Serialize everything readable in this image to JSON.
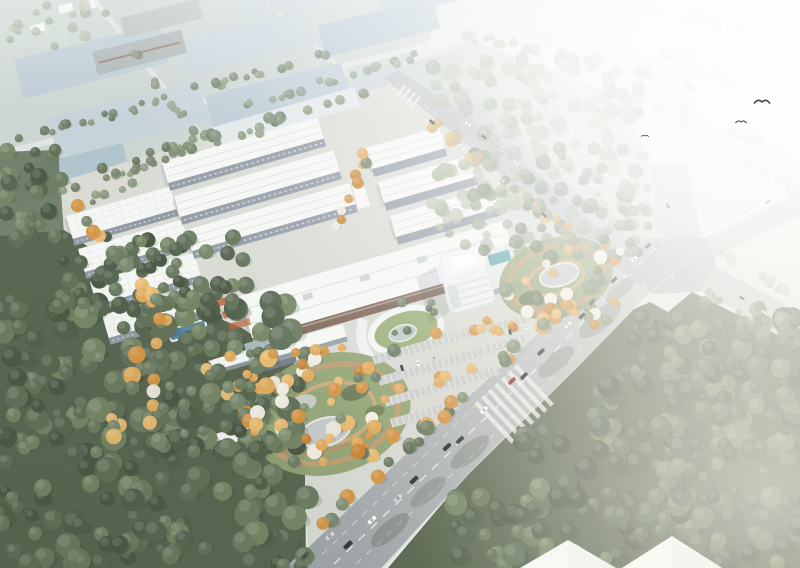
{
  "image": {
    "type": "architectural-aerial-rendering",
    "subject": "Bird's-eye rendering of an industrial park campus: rows of white warehouse buildings, a curved white office tower, landscaped gardens with autumn trees, parking lots, dense green forests and a wide boulevard with traffic crossing a major intersection; distant blue-grey roofed factory district fades into bright haze at the top right.",
    "width": 800,
    "height": 568
  },
  "palette": {
    "bg_a": "#dfe5df",
    "bg_b": "#eceeea",
    "district_ground": "#c9d3d0",
    "district_roof_a": "#b9c9d3",
    "district_roof_b": "#c4d1d8",
    "district_roof_c": "#aec1cc",
    "district_shed": "#a6b1b0",
    "campus_ground": "#d7dad2",
    "roof_white": "#f5f7f4",
    "roof_ridge": "#dde2dd",
    "facade_grey": "#8d96a1",
    "facade_brown": "#7c6252",
    "annex_roof": "#a3b6b8",
    "road_near": "#9da3a6",
    "road_far": "#c7cbca",
    "road_line": "#f4f6f3",
    "apron": "#c3c8c8",
    "forest_dark": "#52604a",
    "forest_right": "#55624b",
    "forest_pale": "#c8d1c4",
    "lawn": "#98ad76",
    "pond": "#c2cacc",
    "pool": "#4f84a6",
    "pool_teal": "#55a1a8",
    "path_tan": "#c29a6f",
    "bed_red": "#b85c35",
    "tower_wall": "#eef1f2",
    "tower_glass": "#b9c4ca",
    "shadow": "#39434b"
  },
  "scene": {
    "car_colors": [
      "#ffffff",
      "#2e3338",
      "#50565c",
      "#8e332c",
      "#d8dadb",
      "#1f2428"
    ],
    "tree_clusters": [
      {
        "name": "forest-topright-fill",
        "shape": "rect",
        "x": 432,
        "y": 58,
        "w": 215,
        "h": 190,
        "n": 150,
        "rmin": 4,
        "rmax": 8,
        "opacity": 0.8,
        "seed": 5,
        "colors": [
          "#99a78d",
          "#a6b297",
          "#b2bba1",
          "#8fa083"
        ]
      },
      {
        "name": "forest-topright-low",
        "shape": "rect",
        "x": 470,
        "y": 148,
        "w": 170,
        "h": 110,
        "n": 60,
        "rmin": 4,
        "rmax": 8,
        "opacity": 0.75,
        "seed": 6,
        "colors": [
          "#68785c",
          "#74866a",
          "#7f9070",
          "#5d6d52"
        ]
      },
      {
        "name": "haze-row-1",
        "shape": "line",
        "x1": 656,
        "y1": 6,
        "x2": 800,
        "y2": 48,
        "jitter": 10,
        "n": 16,
        "rmin": 4,
        "rmax": 6,
        "opacity": 0.6,
        "seed": 7,
        "colors": [
          "#c9bfac",
          "#d6ccba",
          "#beb3a0"
        ]
      },
      {
        "name": "haze-row-2",
        "shape": "line",
        "x1": 640,
        "y1": 50,
        "x2": 800,
        "y2": 100,
        "jitter": 12,
        "n": 18,
        "rmin": 4,
        "rmax": 6,
        "opacity": 0.55,
        "seed": 8,
        "colors": [
          "#c9bfac",
          "#d6ccba",
          "#beb3a0"
        ]
      },
      {
        "name": "haze-row-3",
        "shape": "line",
        "x1": 648,
        "y1": 106,
        "x2": 800,
        "y2": 154,
        "jitter": 12,
        "n": 16,
        "rmin": 4,
        "rmax": 6,
        "opacity": 0.5,
        "seed": 9,
        "colors": [
          "#c9bfac",
          "#d6ccba",
          "#beb3a0"
        ]
      },
      {
        "name": "haze-row-4",
        "shape": "line",
        "x1": 720,
        "y1": 152,
        "x2": 800,
        "y2": 188,
        "jitter": 10,
        "n": 10,
        "rmin": 4,
        "rmax": 6,
        "opacity": 0.45,
        "seed": 10,
        "colors": [
          "#c9bfac",
          "#d6ccba",
          "#beb3a0"
        ]
      },
      {
        "name": "top-road-trees",
        "shape": "line",
        "x1": 460,
        "y1": 34,
        "x2": 700,
        "y2": 86,
        "jitter": 8,
        "n": 20,
        "rmin": 3,
        "rmax": 5,
        "opacity": 0.65,
        "seed": 12,
        "colors": [
          "#99a78d",
          "#a6b297",
          "#b2bba1",
          "#8fa083"
        ]
      },
      {
        "name": "district-row-1",
        "shape": "line",
        "x1": 20,
        "y1": 140,
        "x2": 330,
        "y2": 52,
        "jitter": 8,
        "n": 34,
        "rmin": 3,
        "rmax": 5,
        "opacity": 0.85,
        "seed": 13,
        "colors": [
          "#68785c",
          "#74866a",
          "#7f9070",
          "#5d6d52"
        ]
      },
      {
        "name": "district-row-2",
        "shape": "line",
        "x1": 60,
        "y1": 192,
        "x2": 270,
        "y2": 128,
        "jitter": 8,
        "n": 22,
        "rmin": 3,
        "rmax": 5,
        "opacity": 0.8,
        "seed": 14,
        "colors": [
          "#68785c",
          "#74866a",
          "#7f9070",
          "#5d6d52"
        ]
      },
      {
        "name": "district-row-3",
        "shape": "line",
        "x1": 0,
        "y1": 226,
        "x2": 150,
        "y2": 182,
        "jitter": 8,
        "n": 16,
        "rmin": 3,
        "rmax": 5,
        "opacity": 0.8,
        "seed": 15,
        "colors": [
          "#68785c",
          "#74866a",
          "#7f9070",
          "#5d6d52"
        ]
      },
      {
        "name": "district-row-4",
        "shape": "line",
        "x1": 240,
        "y1": 106,
        "x2": 424,
        "y2": 54,
        "jitter": 8,
        "n": 18,
        "rmin": 3,
        "rmax": 5,
        "opacity": 0.75,
        "seed": 16,
        "colors": [
          "#68785c",
          "#74866a",
          "#7f9070",
          "#5d6d52"
        ]
      },
      {
        "name": "district-row-5",
        "shape": "line",
        "x1": 96,
        "y1": 6,
        "x2": 200,
        "y2": 140,
        "jitter": 8,
        "n": 14,
        "rmin": 3,
        "rmax": 5,
        "opacity": 0.7,
        "seed": 17,
        "colors": [
          "#68785c",
          "#74866a",
          "#7f9070",
          "#5d6d52"
        ]
      },
      {
        "name": "corner-field-trees",
        "shape": "rect",
        "x": 0,
        "y": 0,
        "w": 90,
        "h": 52,
        "n": 14,
        "rmin": 3,
        "rmax": 6,
        "opacity": 0.7,
        "seed": 18,
        "colors": [
          "#99a78d",
          "#a6b297",
          "#b2bba1",
          "#8fa083"
        ]
      },
      {
        "name": "left-strip",
        "shape": "rect",
        "x": 0,
        "y": 150,
        "w": 62,
        "h": 92,
        "n": 26,
        "rmin": 5,
        "rmax": 9,
        "opacity": 0.95,
        "seed": 19,
        "colors": [
          "#44523d",
          "#50604a",
          "#5b6c52",
          "#66775a",
          "#4b5a44",
          "#70815f"
        ]
      },
      {
        "name": "forest-bottomleft",
        "shape": "rect",
        "x": 0,
        "y": 296,
        "w": 308,
        "h": 272,
        "n": 240,
        "rmin": 6,
        "rmax": 13,
        "seed": 20,
        "colors": [
          "#44523d",
          "#50604a",
          "#5b6c52",
          "#66775a",
          "#4b5a44",
          "#70815f"
        ]
      },
      {
        "name": "forest-bottomleft-top",
        "shape": "rect",
        "x": 60,
        "y": 236,
        "w": 190,
        "h": 80,
        "n": 60,
        "rmin": 5,
        "rmax": 9,
        "seed": 21,
        "colors": [
          "#44523d",
          "#50604a",
          "#5b6c52",
          "#66775a",
          "#4b5a44",
          "#70815f"
        ]
      },
      {
        "name": "forest-br-a",
        "shape": "rect",
        "x": 455,
        "y": 495,
        "w": 345,
        "h": 73,
        "n": 85,
        "rmin": 6,
        "rmax": 12,
        "seed": 22,
        "colors": [
          "#44523d",
          "#50604a",
          "#5b6c52",
          "#66775a",
          "#4b5a44",
          "#70815f"
        ]
      },
      {
        "name": "forest-br-b",
        "shape": "rect",
        "x": 520,
        "y": 428,
        "w": 280,
        "h": 72,
        "n": 75,
        "rmin": 6,
        "rmax": 12,
        "seed": 23,
        "colors": [
          "#44523d",
          "#50604a",
          "#5b6c52",
          "#66775a",
          "#4b5a44",
          "#70815f"
        ]
      },
      {
        "name": "forest-br-c",
        "shape": "rect",
        "x": 582,
        "y": 366,
        "w": 218,
        "h": 66,
        "n": 55,
        "rmin": 6,
        "rmax": 12,
        "seed": 24,
        "colors": [
          "#44523d",
          "#50604a",
          "#5b6c52",
          "#66775a",
          "#4b5a44",
          "#70815f"
        ]
      },
      {
        "name": "forest-br-d",
        "shape": "rect",
        "x": 632,
        "y": 316,
        "w": 168,
        "h": 56,
        "n": 42,
        "rmin": 6,
        "rmax": 11,
        "seed": 25,
        "colors": [
          "#44523d",
          "#50604a",
          "#5b6c52",
          "#66775a",
          "#4b5a44",
          "#70815f"
        ]
      },
      {
        "name": "forest-br-e",
        "shape": "rect",
        "x": 700,
        "y": 300,
        "w": 100,
        "h": 36,
        "n": 14,
        "rmin": 5,
        "rmax": 8,
        "opacity": 0.85,
        "seed": 26,
        "colors": [
          "#68785c",
          "#74866a",
          "#7f9070",
          "#5d6d52"
        ]
      },
      {
        "name": "campus-top-row",
        "shape": "line",
        "x1": 100,
        "y1": 170,
        "x2": 386,
        "y2": 88,
        "jitter": 9,
        "n": 26,
        "rmin": 4,
        "rmax": 6,
        "opacity": 0.9,
        "seed": 27,
        "colors": [
          "#68785c",
          "#74866a",
          "#7f9070",
          "#5d6d52"
        ]
      },
      {
        "name": "campus-left-street",
        "shape": "line",
        "x1": 68,
        "y1": 198,
        "x2": 260,
        "y2": 430,
        "jitter": 12,
        "n": 26,
        "rmin": 5,
        "rmax": 8,
        "seed": 28,
        "colors": [
          "#d3923f",
          "#e0a858",
          "#6a7a5e",
          "#75866a",
          "#e8b96d",
          "#5d6e53"
        ]
      },
      {
        "name": "courtyard-trees",
        "shape": "line",
        "x1": 338,
        "y1": 232,
        "x2": 374,
        "y2": 142,
        "jitter": 12,
        "n": 9,
        "rmin": 4,
        "rmax": 6,
        "seed": 29,
        "colors": [
          "#d3923f",
          "#e0a858",
          "#ebe6d9",
          "#6a7a5e",
          "#e8b96d",
          "#c8802f"
        ]
      },
      {
        "name": "roadA-street",
        "shape": "line",
        "x1": 394,
        "y1": 94,
        "x2": 578,
        "y2": 240,
        "jitter": 9,
        "n": 18,
        "rmin": 4,
        "rmax": 6,
        "opacity": 0.9,
        "seed": 30,
        "colors": [
          "#c9a254",
          "#b5a06a",
          "#8fa07a",
          "#d3b06a",
          "#9aa578"
        ]
      },
      {
        "name": "boulevard-street",
        "shape": "line",
        "x1": 316,
        "y1": 530,
        "x2": 600,
        "y2": 272,
        "jitter": 10,
        "n": 26,
        "rmin": 5,
        "rmax": 8,
        "seed": 31,
        "colors": [
          "#68785c",
          "#74866a",
          "#d3923f",
          "#7f9070",
          "#5d6d52",
          "#e0a858"
        ]
      },
      {
        "name": "garden1-trees",
        "shape": "rect",
        "x": 250,
        "y": 350,
        "w": 145,
        "h": 112,
        "n": 50,
        "rmin": 4,
        "rmax": 8,
        "seed": 32,
        "colors": [
          "#d3923f",
          "#e0a858",
          "#ebe6d9",
          "#6a7a5e",
          "#e8b96d",
          "#f0ede3",
          "#c8802f",
          "#81926f"
        ]
      },
      {
        "name": "garden2-trees",
        "shape": "rect",
        "x": 500,
        "y": 238,
        "w": 120,
        "h": 90,
        "n": 34,
        "rmin": 4,
        "rmax": 7,
        "seed": 33,
        "colors": [
          "#d3923f",
          "#e0a858",
          "#ebe6d9",
          "#6a7a5e",
          "#e8b96d",
          "#f0ede3",
          "#c8802f",
          "#81926f"
        ]
      },
      {
        "name": "campus-scatter",
        "shape": "rect",
        "x": 96,
        "y": 342,
        "w": 176,
        "h": 108,
        "n": 28,
        "rmin": 5,
        "rmax": 9,
        "seed": 34,
        "colors": [
          "#d3923f",
          "#e0a858",
          "#6a7a5e",
          "#75866a",
          "#e8b96d",
          "#5d6e53"
        ]
      },
      {
        "name": "e-garden",
        "shape": "rect",
        "x": 152,
        "y": 372,
        "w": 100,
        "h": 66,
        "n": 14,
        "rmin": 4,
        "rmax": 7,
        "seed": 35,
        "colors": [
          "#68785c",
          "#ebe6d9",
          "#74866a",
          "#e0a858"
        ]
      },
      {
        "name": "p1-trees-a",
        "shape": "line",
        "x1": 380,
        "y1": 352,
        "x2": 490,
        "y2": 322,
        "jitter": 8,
        "n": 5,
        "rmin": 4,
        "rmax": 6,
        "seed": 36,
        "colors": [
          "#d3923f",
          "#e0a858",
          "#c8802f",
          "#e8b96d"
        ]
      },
      {
        "name": "p1-trees-b",
        "shape": "line",
        "x1": 390,
        "y1": 394,
        "x2": 478,
        "y2": 368,
        "jitter": 8,
        "n": 5,
        "rmin": 4,
        "rmax": 6,
        "seed": 37,
        "colors": [
          "#d3923f",
          "#e0a858",
          "#c8802f",
          "#e8b96d"
        ]
      },
      {
        "name": "p2-trees",
        "shape": "line",
        "x1": 482,
        "y1": 336,
        "x2": 520,
        "y2": 325,
        "jitter": 7,
        "n": 4,
        "rmin": 4,
        "rmax": 5,
        "seed": 38,
        "colors": [
          "#d3923f",
          "#e0a858",
          "#c8802f",
          "#e8b96d"
        ]
      },
      {
        "name": "se-arm-row-a",
        "shape": "line",
        "x1": 704,
        "y1": 292,
        "x2": 800,
        "y2": 348,
        "jitter": 7,
        "n": 11,
        "rmin": 3,
        "rmax": 5,
        "opacity": 0.6,
        "seed": 39,
        "colors": [
          "#68785c",
          "#74866a",
          "#7f9070",
          "#5d6d52"
        ]
      },
      {
        "name": "se-arm-row-b",
        "shape": "line",
        "x1": 716,
        "y1": 252,
        "x2": 800,
        "y2": 300,
        "jitter": 7,
        "n": 10,
        "rmin": 3,
        "rmax": 5,
        "opacity": 0.55,
        "seed": 40,
        "colors": [
          "#99a78d",
          "#a6b297",
          "#b2bba1",
          "#8fa083"
        ]
      },
      {
        "name": "n-arm-left-row",
        "shape": "rect",
        "x": 618,
        "y": 176,
        "w": 34,
        "h": 70,
        "n": 12,
        "rmin": 4,
        "rmax": 6,
        "opacity": 0.7,
        "seed": 41,
        "colors": [
          "#68785c",
          "#74866a",
          "#7f9070",
          "#5d6d52"
        ]
      },
      {
        "name": "garden1-approach",
        "shape": "line",
        "x1": 270,
        "y1": 352,
        "x2": 360,
        "y2": 346,
        "jitter": 8,
        "n": 6,
        "rmin": 4,
        "rmax": 6,
        "seed": 42,
        "colors": [
          "#d3923f",
          "#e0a858",
          "#6a7a5e",
          "#75866a"
        ]
      },
      {
        "name": "tower-greens",
        "shape": "rect",
        "x": 392,
        "y": 300,
        "w": 42,
        "h": 44,
        "n": 6,
        "rmin": 3,
        "rmax": 5,
        "seed": 43,
        "colors": [
          "#68785c",
          "#74866a",
          "#7f9070",
          "#5d6d52"
        ]
      }
    ],
    "cars": [
      [
        348,
        545,
        -42,
        1,
        1
      ],
      [
        330,
        536,
        -42,
        1,
        4
      ],
      [
        372,
        520,
        -42,
        0.98,
        0
      ],
      [
        414,
        480,
        -43,
        0.95,
        1
      ],
      [
        447,
        447,
        -43,
        0.92,
        5
      ],
      [
        484,
        410,
        -44,
        0.88,
        0
      ],
      [
        512,
        381,
        -44,
        0.85,
        3
      ],
      [
        541,
        352,
        -44,
        0.82,
        1
      ],
      [
        568,
        325,
        -45,
        0.78,
        0
      ],
      [
        592,
        302,
        -45,
        0.74,
        2
      ],
      [
        614,
        280,
        -45,
        0.7,
        1
      ],
      [
        634,
        259,
        -45,
        0.66,
        0
      ],
      [
        305,
        556,
        -42,
        1,
        2
      ],
      [
        398,
        498,
        -43,
        0.95,
        4
      ],
      [
        460,
        440,
        -43,
        0.9,
        1
      ],
      [
        524,
        376,
        -44,
        0.84,
        5
      ],
      [
        582,
        316,
        -45,
        0.76,
        1
      ],
      [
        604,
        296,
        -45,
        0.72,
        4
      ],
      [
        648,
        246,
        -46,
        0.62,
        1
      ],
      [
        660,
        236,
        -46,
        0.6,
        0
      ],
      [
        668,
        206,
        62,
        0.55,
        1
      ],
      [
        676,
        222,
        62,
        0.55,
        0
      ],
      [
        746,
        212,
        -26,
        0.5,
        4
      ],
      [
        768,
        202,
        -26,
        0.48,
        1
      ],
      [
        742,
        298,
        28,
        0.55,
        1
      ],
      [
        764,
        312,
        28,
        0.5,
        0
      ],
      [
        730,
        288,
        28,
        0.55,
        4
      ],
      [
        432,
        122,
        38,
        0.62,
        1
      ],
      [
        462,
        147,
        38,
        0.6,
        0
      ],
      [
        502,
        180,
        39,
        0.6,
        4
      ],
      [
        544,
        215,
        40,
        0.58,
        1
      ],
      [
        468,
        124,
        38,
        0.6,
        0
      ],
      [
        484,
        137,
        38,
        0.58,
        1
      ],
      [
        500,
        150,
        38,
        0.58,
        4
      ],
      [
        516,
        163,
        38,
        0.56,
        0
      ],
      [
        402,
        368,
        74,
        0.62,
        1
      ],
      [
        418,
        363,
        74,
        0.62,
        0
      ],
      [
        434,
        358,
        74,
        0.6,
        4
      ],
      [
        510,
        332,
        74,
        0.55,
        1
      ],
      [
        526,
        327,
        74,
        0.55,
        0
      ]
    ],
    "birds": [
      {
        "x": 762,
        "y": 102,
        "s": 1.1
      },
      {
        "x": 741,
        "y": 122,
        "s": 0.75
      },
      {
        "x": 645,
        "y": 136,
        "s": 0.5
      }
    ]
  }
}
